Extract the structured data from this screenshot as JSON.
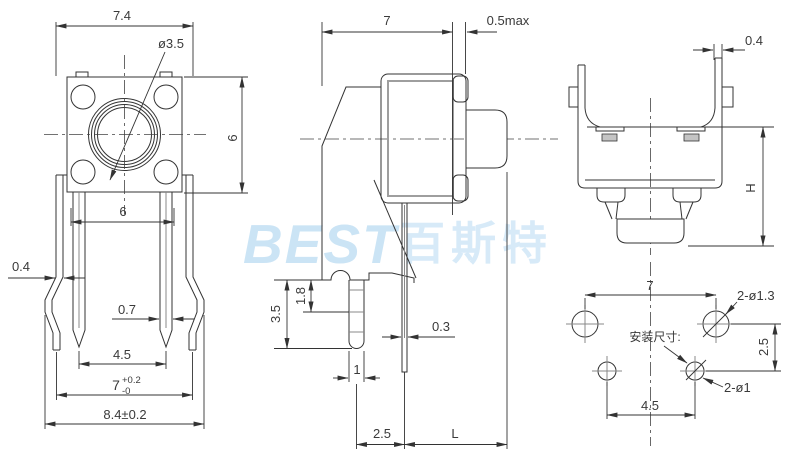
{
  "watermark": {
    "latin": "BEST",
    "chinese": "百斯特"
  },
  "colors": {
    "line": "#333333",
    "inner_line": "#9e9e9e",
    "watermark_blue": "#cbe4f5",
    "background": "#ffffff"
  },
  "views": {
    "front_view": {
      "dims": {
        "bracket_width": "7.4",
        "button_diameter": "ø3.5",
        "body_height": "6",
        "pin_span": "6",
        "clip_thickness": "0.4",
        "pin_width": "0.7",
        "pin_pitch": "4.5",
        "foot_span": "7",
        "foot_span_tol_plus": "+0.2",
        "foot_span_tol_minus": "-0",
        "overall_width": "8.4±0.2"
      }
    },
    "side_view": {
      "dims": {
        "body_width": "7",
        "cover_gap": "0.5max",
        "bracket_depth": "3.5",
        "slot_depth": "1.8",
        "pin_thickness": "0.3",
        "leg_width": "1",
        "pin_to_leg": "2.5",
        "stem_length": "L"
      }
    },
    "top_view": {
      "dims": {
        "wall_thickness": "0.4",
        "stem_height": "H"
      }
    },
    "mounting_layout": {
      "caption": "安装尺寸:",
      "dims": {
        "clip_hole_pitch": "7",
        "clip_holes": "2-ø1.3",
        "row_spacing": "2.5",
        "pin_hole_pitch": "4.5",
        "pin_holes": "2-ø1"
      }
    }
  }
}
